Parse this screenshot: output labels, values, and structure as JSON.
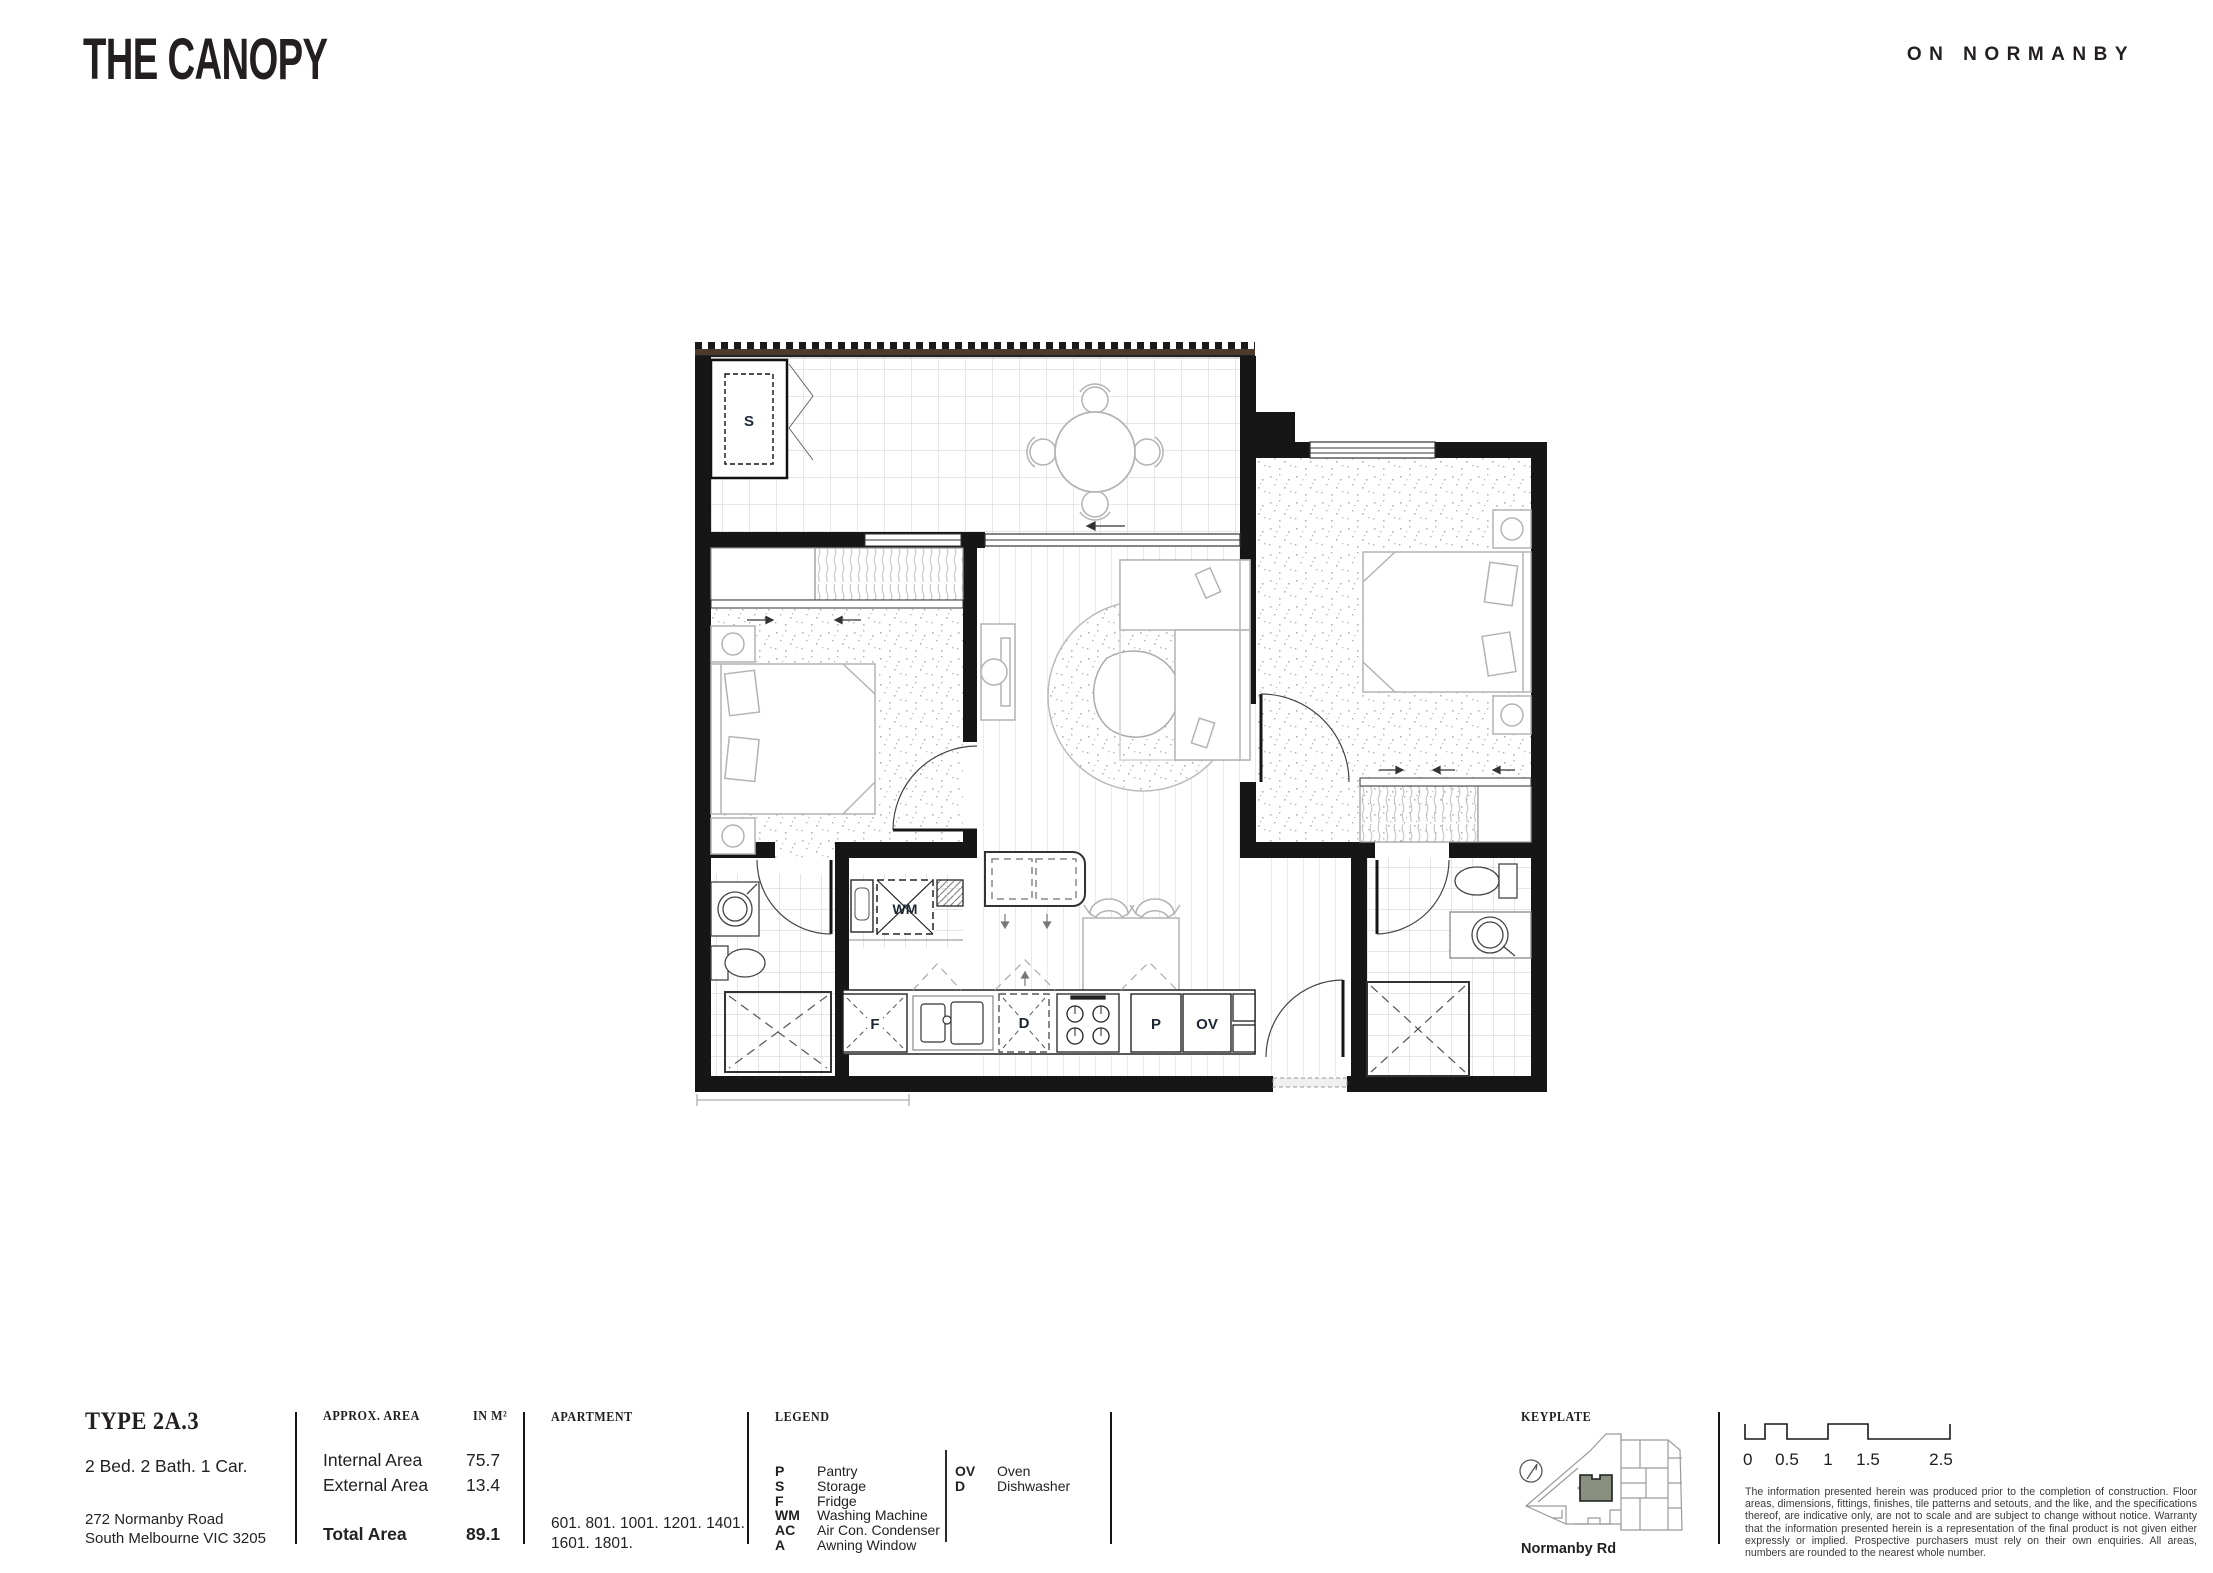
{
  "header": {
    "title": "THE CANOPY",
    "brand": "ON NORMANBY"
  },
  "plan": {
    "labels": {
      "storage": "S",
      "washing_machine": "WM",
      "fridge": "F",
      "dishwasher": "D",
      "pantry": "P",
      "oven": "OV"
    }
  },
  "footer": {
    "type": {
      "title": "TYPE 2A.3",
      "config": "2 Bed. 2 Bath. 1 Car.",
      "address_line1": "272 Normanby Road",
      "address_line2": "South Melbourne VIC 3205"
    },
    "area": {
      "header_label": "APPROX. AREA",
      "header_unit": "IN M²",
      "rows": [
        {
          "label": "Internal Area",
          "value": "75.7"
        },
        {
          "label": "External Area",
          "value": "13.4"
        }
      ],
      "total": {
        "label": "Total Area",
        "value": "89.1"
      }
    },
    "apartment": {
      "header": "APARTMENT",
      "numbers_line1": "601. 801. 1001. 1201. 1401.",
      "numbers_line2": "1601. 1801."
    },
    "legend": {
      "header": "LEGEND",
      "col1": [
        [
          "P",
          "Pantry"
        ],
        [
          "S",
          "Storage"
        ],
        [
          "F",
          "Fridge"
        ],
        [
          "WM",
          "Washing Machine"
        ],
        [
          "AC",
          "Air Con. Condenser"
        ],
        [
          "A",
          "Awning Window"
        ]
      ],
      "col2": [
        [
          "OV",
          "Oven"
        ],
        [
          "D",
          "Dishwasher"
        ]
      ]
    },
    "keyplate": {
      "header": "KEYPLATE",
      "road": "Normanby Rd",
      "highlight_color": "#8a8f7d"
    },
    "scalebar": {
      "ticks": [
        "0",
        "0.5",
        "1",
        "1.5",
        "2.5"
      ]
    },
    "disclaimer": "The information presented herein was produced prior to the completion of construction. Floor areas, dimensions, fittings, finishes, tile patterns and setouts, and the like, and the specifications thereof, are indicative only, are not to scale and are subject to change without notice. Warranty that the information presented herein is a representation of the final product is not given either expressly or implied. Prospective purchasers must rely on their own enquiries. All areas, numbers are rounded to the nearest whole number."
  }
}
